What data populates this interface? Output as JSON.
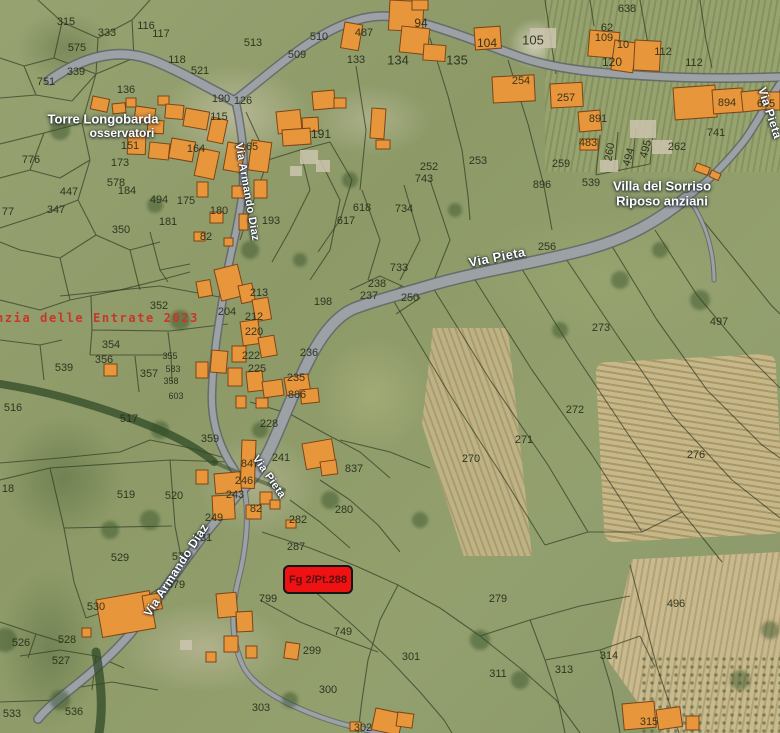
{
  "map": {
    "watermark_text": "nzia delle Entrate 2023",
    "highlight_parcel": {
      "label": "Fg 2/Pt.288"
    },
    "colors": {
      "building_fill": "#e8963c",
      "building_stroke": "#7c4515",
      "highlight_red": "#ef1212",
      "watermark_red": "#c8362a",
      "road_fill": "#9ba1a4",
      "road_casing": "#5f646b",
      "parcel_line": "#2e3820"
    },
    "place_labels": [
      {
        "text": "Torre Longobarda",
        "x": 103,
        "y": 119,
        "size": 13
      },
      {
        "text": "osservatori",
        "x": 122,
        "y": 133,
        "size": 12
      },
      {
        "text": "Villa del Sorriso",
        "x": 662,
        "y": 186,
        "size": 13
      },
      {
        "text": "Riposo anziani",
        "x": 662,
        "y": 201,
        "size": 13
      }
    ],
    "street_labels": [
      {
        "text": "Via Pieta",
        "x": 497,
        "y": 257,
        "rotate": -11,
        "size": 13
      },
      {
        "text": "Via Pietà",
        "x": 770,
        "y": 113,
        "rotate": 72,
        "size": 12
      },
      {
        "text": "Via Pieta",
        "x": 269,
        "y": 477,
        "rotate": 55,
        "size": 11
      },
      {
        "text": "Via Armando Diaz",
        "x": 176,
        "y": 570,
        "rotate": -57,
        "size": 12
      },
      {
        "text": "Via Armando Diaz",
        "x": 247,
        "y": 192,
        "rotate": 80,
        "size": 11
      }
    ],
    "parcel_labels": [
      {
        "t": "315",
        "x": 66,
        "y": 22
      },
      {
        "t": "333",
        "x": 107,
        "y": 33
      },
      {
        "t": "575",
        "x": 77,
        "y": 48
      },
      {
        "t": "339",
        "x": 76,
        "y": 72
      },
      {
        "t": "751",
        "x": 46,
        "y": 82
      },
      {
        "t": "513",
        "x": 253,
        "y": 43
      },
      {
        "t": "116",
        "x": 146,
        "y": 26
      },
      {
        "t": "117",
        "x": 161,
        "y": 34
      },
      {
        "t": "118",
        "x": 177,
        "y": 60
      },
      {
        "t": "521",
        "x": 200,
        "y": 71
      },
      {
        "t": "136",
        "x": 126,
        "y": 90
      },
      {
        "t": "190",
        "x": 221,
        "y": 99
      },
      {
        "t": "126",
        "x": 243,
        "y": 101
      },
      {
        "t": "115",
        "x": 219,
        "y": 117
      },
      {
        "t": "164",
        "x": 196,
        "y": 149
      },
      {
        "t": "165",
        "x": 249,
        "y": 147
      },
      {
        "t": "776",
        "x": 31,
        "y": 160
      },
      {
        "t": "151",
        "x": 130,
        "y": 146
      },
      {
        "t": "173",
        "x": 120,
        "y": 163
      },
      {
        "t": "578",
        "x": 116,
        "y": 183
      },
      {
        "t": "184",
        "x": 127,
        "y": 191
      },
      {
        "t": "447",
        "x": 69,
        "y": 192
      },
      {
        "t": "347",
        "x": 56,
        "y": 210
      },
      {
        "t": "77",
        "x": 8,
        "y": 212
      },
      {
        "t": "494",
        "x": 159,
        "y": 200
      },
      {
        "t": "175",
        "x": 186,
        "y": 201
      },
      {
        "t": "180",
        "x": 219,
        "y": 211
      },
      {
        "t": "181",
        "x": 168,
        "y": 222
      },
      {
        "t": "350",
        "x": 121,
        "y": 230
      },
      {
        "t": "193",
        "x": 271,
        "y": 221
      },
      {
        "t": "82",
        "x": 206,
        "y": 237
      },
      {
        "t": "510",
        "x": 319,
        "y": 37
      },
      {
        "t": "487",
        "x": 364,
        "y": 33
      },
      {
        "t": "509",
        "x": 297,
        "y": 55
      },
      {
        "t": "94",
        "x": 421,
        "y": 23,
        "s": 12
      },
      {
        "t": "104",
        "x": 487,
        "y": 43,
        "s": 12
      },
      {
        "t": "133",
        "x": 356,
        "y": 60
      },
      {
        "t": "134",
        "x": 398,
        "y": 60,
        "s": 13
      },
      {
        "t": "135",
        "x": 457,
        "y": 60,
        "s": 13
      },
      {
        "t": "254",
        "x": 521,
        "y": 81
      },
      {
        "t": "191",
        "x": 321,
        "y": 134,
        "s": 12
      },
      {
        "t": "252",
        "x": 429,
        "y": 167
      },
      {
        "t": "743",
        "x": 424,
        "y": 179
      },
      {
        "t": "253",
        "x": 478,
        "y": 161
      },
      {
        "t": "105",
        "x": 533,
        "y": 40,
        "s": 13
      },
      {
        "t": "638",
        "x": 627,
        "y": 9
      },
      {
        "t": "62",
        "x": 607,
        "y": 28
      },
      {
        "t": "109",
        "x": 604,
        "y": 38
      },
      {
        "t": "10",
        "x": 623,
        "y": 45
      },
      {
        "t": "120",
        "x": 612,
        "y": 62,
        "s": 12
      },
      {
        "t": "112",
        "x": 663,
        "y": 52
      },
      {
        "t": "112",
        "x": 694,
        "y": 63
      },
      {
        "t": "257",
        "x": 566,
        "y": 98
      },
      {
        "t": "894",
        "x": 727,
        "y": 103
      },
      {
        "t": "645",
        "x": 766,
        "y": 104
      },
      {
        "t": "891",
        "x": 598,
        "y": 119
      },
      {
        "t": "483",
        "x": 588,
        "y": 143
      },
      {
        "t": "741",
        "x": 716,
        "y": 133
      },
      {
        "t": "259",
        "x": 561,
        "y": 164
      },
      {
        "t": "896",
        "x": 542,
        "y": 185
      },
      {
        "t": "539",
        "x": 591,
        "y": 183
      },
      {
        "t": "260",
        "x": 610,
        "y": 152,
        "r": -80
      },
      {
        "t": "494",
        "x": 629,
        "y": 157,
        "r": -75
      },
      {
        "t": "495",
        "x": 646,
        "y": 149,
        "r": -75
      },
      {
        "t": "262",
        "x": 677,
        "y": 147
      },
      {
        "t": "198",
        "x": 323,
        "y": 302
      },
      {
        "t": "256",
        "x": 547,
        "y": 247
      },
      {
        "t": "273",
        "x": 601,
        "y": 328
      },
      {
        "t": "497",
        "x": 719,
        "y": 322
      },
      {
        "t": "272",
        "x": 575,
        "y": 410
      },
      {
        "t": "271",
        "x": 524,
        "y": 440
      },
      {
        "t": "270",
        "x": 471,
        "y": 459
      },
      {
        "t": "276",
        "x": 696,
        "y": 455
      },
      {
        "t": "618",
        "x": 362,
        "y": 208
      },
      {
        "t": "617",
        "x": 346,
        "y": 221
      },
      {
        "t": "734",
        "x": 404,
        "y": 209
      },
      {
        "t": "733",
        "x": 399,
        "y": 268
      },
      {
        "t": "238",
        "x": 377,
        "y": 284
      },
      {
        "t": "237",
        "x": 369,
        "y": 296
      },
      {
        "t": "250",
        "x": 410,
        "y": 298
      },
      {
        "t": "352",
        "x": 159,
        "y": 306
      },
      {
        "t": "354",
        "x": 111,
        "y": 345
      },
      {
        "t": "356",
        "x": 104,
        "y": 360
      },
      {
        "t": "357",
        "x": 149,
        "y": 374
      },
      {
        "t": "355",
        "x": 170,
        "y": 356,
        "s": 9
      },
      {
        "t": "583",
        "x": 173,
        "y": 369,
        "s": 9
      },
      {
        "t": "358",
        "x": 171,
        "y": 381,
        "s": 9
      },
      {
        "t": "603",
        "x": 176,
        "y": 396,
        "s": 9
      },
      {
        "t": "539",
        "x": 64,
        "y": 368
      },
      {
        "t": "516",
        "x": 13,
        "y": 408
      },
      {
        "t": "517",
        "x": 129,
        "y": 419
      },
      {
        "t": "204",
        "x": 227,
        "y": 312
      },
      {
        "t": "213",
        "x": 259,
        "y": 293
      },
      {
        "t": "212",
        "x": 254,
        "y": 317
      },
      {
        "t": "220",
        "x": 254,
        "y": 332
      },
      {
        "t": "222",
        "x": 251,
        "y": 356
      },
      {
        "t": "225",
        "x": 257,
        "y": 369
      },
      {
        "t": "235",
        "x": 296,
        "y": 378
      },
      {
        "t": "236",
        "x": 309,
        "y": 353
      },
      {
        "t": "886",
        "x": 297,
        "y": 395
      },
      {
        "t": "228",
        "x": 269,
        "y": 424
      },
      {
        "t": "359",
        "x": 210,
        "y": 439
      },
      {
        "t": "241",
        "x": 281,
        "y": 458
      },
      {
        "t": "847",
        "x": 250,
        "y": 464
      },
      {
        "t": "246",
        "x": 244,
        "y": 481
      },
      {
        "t": "243",
        "x": 235,
        "y": 495
      },
      {
        "t": "249",
        "x": 214,
        "y": 518
      },
      {
        "t": "82",
        "x": 256,
        "y": 509
      },
      {
        "t": "282",
        "x": 298,
        "y": 520
      },
      {
        "t": "280",
        "x": 344,
        "y": 510
      },
      {
        "t": "837",
        "x": 354,
        "y": 469
      },
      {
        "t": "531",
        "x": 203,
        "y": 538
      },
      {
        "t": "578",
        "x": 181,
        "y": 557
      },
      {
        "t": "579",
        "x": 176,
        "y": 585
      },
      {
        "t": "520",
        "x": 174,
        "y": 496
      },
      {
        "t": "287",
        "x": 296,
        "y": 547
      },
      {
        "t": "799",
        "x": 268,
        "y": 599
      },
      {
        "t": "749",
        "x": 343,
        "y": 632
      },
      {
        "t": "299",
        "x": 312,
        "y": 651
      },
      {
        "t": "301",
        "x": 411,
        "y": 657
      },
      {
        "t": "300",
        "x": 328,
        "y": 690
      },
      {
        "t": "303",
        "x": 261,
        "y": 708
      },
      {
        "t": "302",
        "x": 363,
        "y": 728
      },
      {
        "t": "311",
        "x": 498,
        "y": 674
      },
      {
        "t": "313",
        "x": 564,
        "y": 670
      },
      {
        "t": "314",
        "x": 609,
        "y": 656
      },
      {
        "t": "315",
        "x": 649,
        "y": 722
      },
      {
        "t": "279",
        "x": 498,
        "y": 599
      },
      {
        "t": "496",
        "x": 676,
        "y": 604
      },
      {
        "t": "18",
        "x": 8,
        "y": 489
      },
      {
        "t": "519",
        "x": 126,
        "y": 495
      },
      {
        "t": "529",
        "x": 120,
        "y": 558
      },
      {
        "t": "530",
        "x": 96,
        "y": 607
      },
      {
        "t": "526",
        "x": 21,
        "y": 643
      },
      {
        "t": "528",
        "x": 67,
        "y": 640
      },
      {
        "t": "527",
        "x": 61,
        "y": 661
      },
      {
        "t": "533",
        "x": 12,
        "y": 714
      },
      {
        "t": "536",
        "x": 74,
        "y": 712
      }
    ]
  }
}
